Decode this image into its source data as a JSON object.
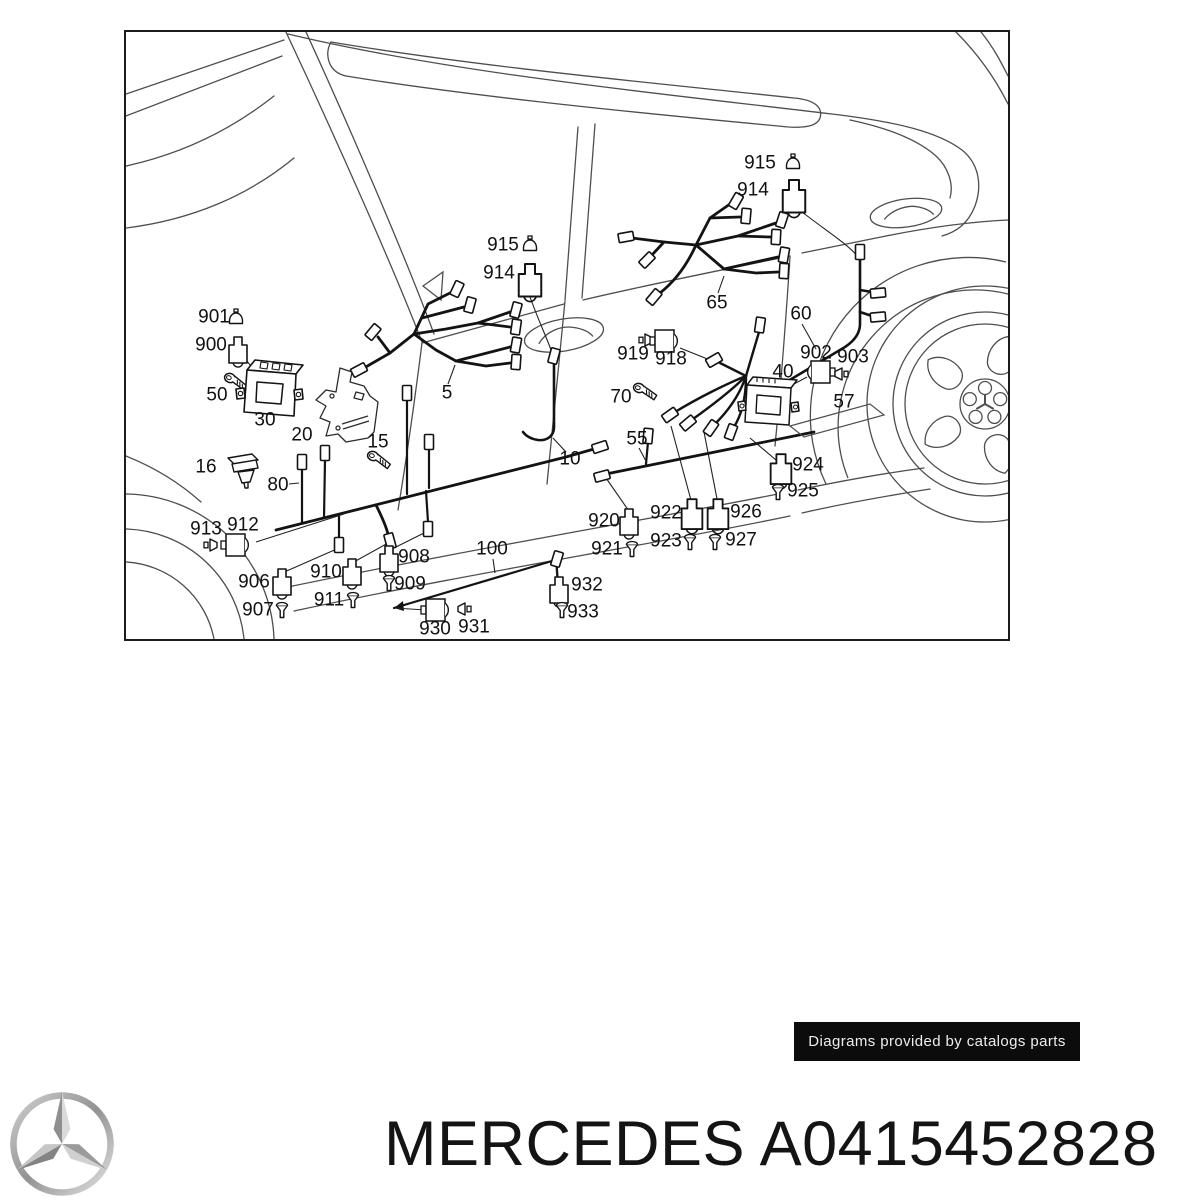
{
  "badge": {
    "text": "Diagrams provided by catalogs parts",
    "bg": "#0c0c0c",
    "fg": "#ededed"
  },
  "footer": {
    "brand": "MERCEDES",
    "part_number": "A0415452828",
    "title": "MERCEDES A0415452828"
  },
  "icons": {
    "logo": "mercedes-three-pointed-star"
  },
  "diagram": {
    "border_color": "#1c1c1c",
    "body_line_color": "#4e4e4e",
    "harness_color": "#131313",
    "labels": [
      {
        "text": "901",
        "x": 88,
        "y": 285
      },
      {
        "text": "900",
        "x": 85,
        "y": 313
      },
      {
        "text": "50",
        "x": 91,
        "y": 363
      },
      {
        "text": "30",
        "x": 139,
        "y": 388
      },
      {
        "text": "20",
        "x": 176,
        "y": 403
      },
      {
        "text": "16",
        "x": 80,
        "y": 435
      },
      {
        "text": "80",
        "x": 152,
        "y": 453
      },
      {
        "text": "15",
        "x": 252,
        "y": 410
      },
      {
        "text": "5",
        "x": 321,
        "y": 361
      },
      {
        "text": "10",
        "x": 444,
        "y": 427
      },
      {
        "text": "915",
        "x": 377,
        "y": 213
      },
      {
        "text": "914",
        "x": 373,
        "y": 241
      },
      {
        "text": "915",
        "x": 634,
        "y": 131
      },
      {
        "text": "914",
        "x": 627,
        "y": 158
      },
      {
        "text": "65",
        "x": 591,
        "y": 271
      },
      {
        "text": "60",
        "x": 675,
        "y": 282
      },
      {
        "text": "919",
        "x": 507,
        "y": 322
      },
      {
        "text": "918",
        "x": 545,
        "y": 327
      },
      {
        "text": "70",
        "x": 495,
        "y": 365
      },
      {
        "text": "902",
        "x": 690,
        "y": 321
      },
      {
        "text": "903",
        "x": 727,
        "y": 325
      },
      {
        "text": "40",
        "x": 657,
        "y": 340
      },
      {
        "text": "57",
        "x": 718,
        "y": 370
      },
      {
        "text": "55",
        "x": 511,
        "y": 407
      },
      {
        "text": "924",
        "x": 682,
        "y": 433
      },
      {
        "text": "925",
        "x": 677,
        "y": 459
      },
      {
        "text": "920",
        "x": 478,
        "y": 489
      },
      {
        "text": "921",
        "x": 481,
        "y": 517
      },
      {
        "text": "922",
        "x": 540,
        "y": 481
      },
      {
        "text": "923",
        "x": 540,
        "y": 509
      },
      {
        "text": "926",
        "x": 620,
        "y": 480
      },
      {
        "text": "927",
        "x": 615,
        "y": 508
      },
      {
        "text": "913",
        "x": 80,
        "y": 497
      },
      {
        "text": "912",
        "x": 117,
        "y": 493
      },
      {
        "text": "906",
        "x": 128,
        "y": 550
      },
      {
        "text": "907",
        "x": 132,
        "y": 578
      },
      {
        "text": "910",
        "x": 200,
        "y": 540
      },
      {
        "text": "911",
        "x": 203,
        "y": 568
      },
      {
        "text": "908",
        "x": 288,
        "y": 525
      },
      {
        "text": "909",
        "x": 284,
        "y": 552
      },
      {
        "text": "100",
        "x": 366,
        "y": 517
      },
      {
        "text": "932",
        "x": 461,
        "y": 553
      },
      {
        "text": "933",
        "x": 457,
        "y": 580
      },
      {
        "text": "930",
        "x": 309,
        "y": 597
      },
      {
        "text": "931",
        "x": 348,
        "y": 595
      }
    ]
  }
}
